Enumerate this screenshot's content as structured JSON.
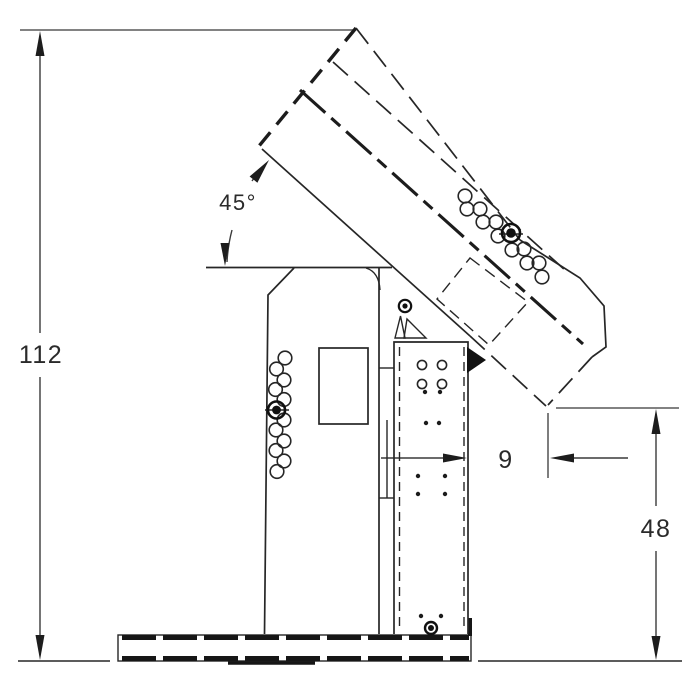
{
  "title": "Machine side elevation drawing with dimensions",
  "colors": {
    "object_line": "#262626",
    "dimension_line": "#3a3a3a",
    "extension_line": "#707070",
    "background": "#ffffff"
  },
  "dimensions": {
    "overall_height": {
      "label": "112"
    },
    "boom_angle": {
      "label": "45°"
    },
    "offset": {
      "label": "9"
    },
    "discharge_height": {
      "label": "48"
    }
  }
}
